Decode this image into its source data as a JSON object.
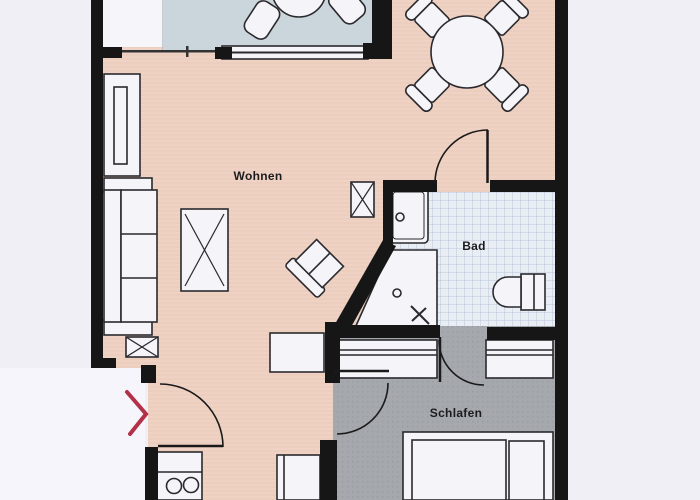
{
  "meta": {
    "type": "apartment-floor-plan-scan",
    "language": "de"
  },
  "rooms": {
    "wohnen": {
      "label": "Wohnen",
      "floor_color": "#f0d2c4"
    },
    "bad": {
      "label": "Bad",
      "floor_color": "#e9eef5"
    },
    "schlafen": {
      "label": "Schlafen",
      "floor_color": "#a5a9ae"
    },
    "balkon": {
      "label": "",
      "floor_color": "#cbd5dc"
    }
  },
  "colors": {
    "background": "#f1eff6",
    "wall": "#161616",
    "furniture_fill": "#f5f4f9",
    "furniture_stroke": "#2a2a2e",
    "tile_line": "#b9c5d8",
    "entrance_arrow_red": "#b23048",
    "living_stripe": "#e4c0b1"
  },
  "features": [
    {
      "name": "balcony-table",
      "room": "balkon"
    },
    {
      "name": "balcony-chairs",
      "room": "balkon"
    },
    {
      "name": "dining-table",
      "room": "wohnen"
    },
    {
      "name": "dining-chairs",
      "room": "wohnen"
    },
    {
      "name": "shelf-cabinet",
      "room": "wohnen"
    },
    {
      "name": "sofa",
      "room": "wohnen"
    },
    {
      "name": "side-table",
      "room": "wohnen"
    },
    {
      "name": "coffee-table",
      "room": "wohnen"
    },
    {
      "name": "armchair",
      "room": "wohnen"
    },
    {
      "name": "sideboard",
      "room": "wohnen"
    },
    {
      "name": "kitchenette-stove",
      "room": "wohnen"
    },
    {
      "name": "tall-cabinet",
      "room": "wohnen"
    },
    {
      "name": "washbasin",
      "room": "bad"
    },
    {
      "name": "corner-shower",
      "room": "bad"
    },
    {
      "name": "toilet",
      "room": "bad"
    },
    {
      "name": "wardrobes",
      "room": "schlafen"
    },
    {
      "name": "double-bed",
      "room": "schlafen"
    },
    {
      "name": "entrance-arrow",
      "room": "entrance"
    }
  ]
}
